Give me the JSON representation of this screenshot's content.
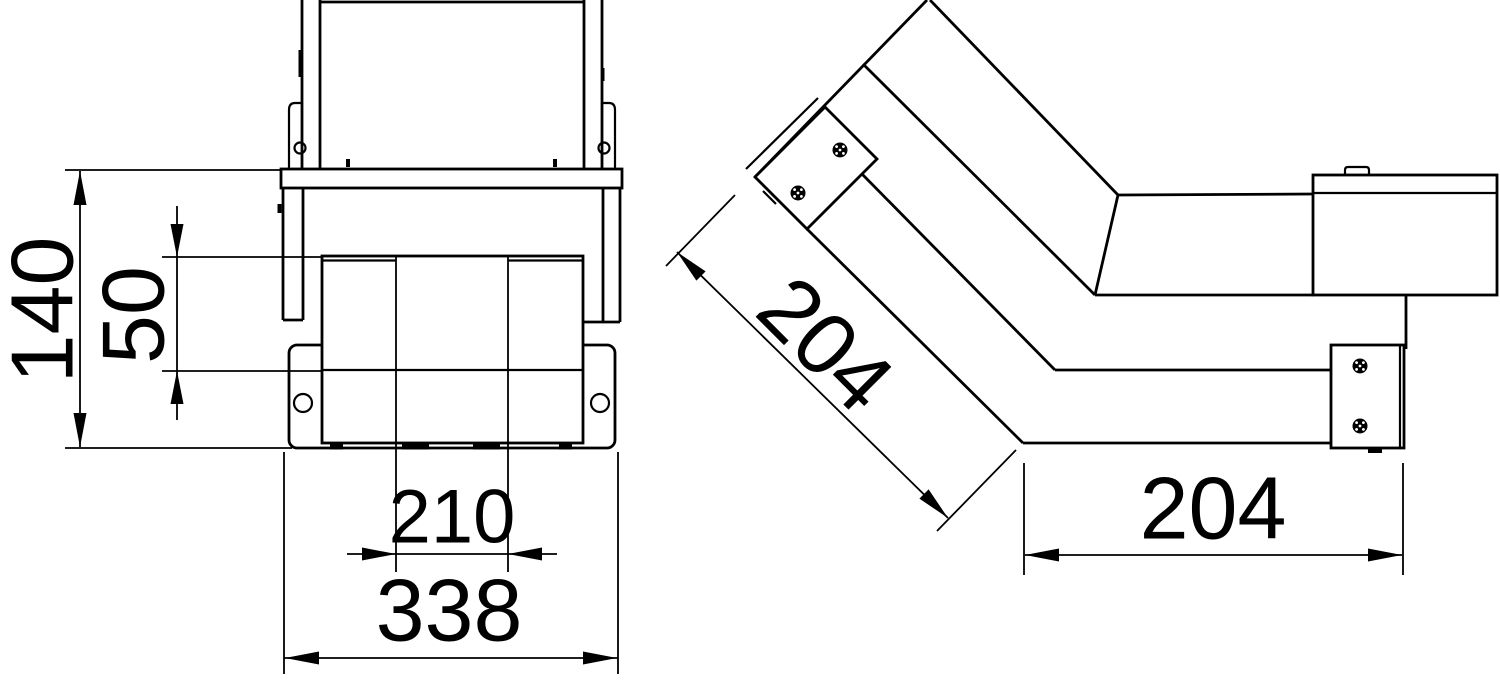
{
  "drawing": {
    "type": "technical-drawing",
    "description": "Two-view dimensioned engineering drawing of a 45-degree cable-duct bend piece",
    "views": {
      "front_label": "front-view",
      "side_label": "side-view"
    },
    "dimensions": {
      "overall_height": "140",
      "channel_height": "50",
      "inner_width": "210",
      "overall_width": "338",
      "diagonal_length": "204",
      "horizontal_length": "204"
    },
    "colors": {
      "line": "#000000",
      "background": "#ffffff"
    }
  }
}
